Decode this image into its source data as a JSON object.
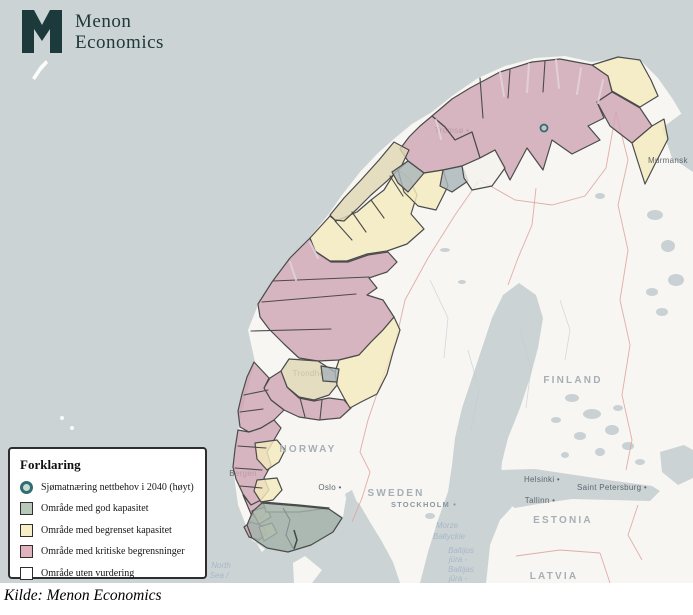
{
  "logo": {
    "line1": "Menon",
    "line2": "Economics",
    "mark_color": "#1c393b"
  },
  "caption": {
    "text": "Kilde: Menon Economics"
  },
  "legend": {
    "title": "Forklaring",
    "items": [
      {
        "shape": "circle",
        "ring": "#2c6e73",
        "fill": "#cdd9d0",
        "label": "Sjømatnæring nettbehov i 2040 (høyt)"
      },
      {
        "shape": "square",
        "fill": "#b7c8b8",
        "label": "Område med god kapasitet"
      },
      {
        "shape": "square",
        "fill": "#f7eec7",
        "label": "Område med begrenset kapasitet"
      },
      {
        "shape": "square",
        "fill": "#e0b3bf",
        "label": "Område med kritiske begrensninger"
      },
      {
        "shape": "square",
        "fill": "#ffffff",
        "label": "Område uten vurdering"
      }
    ]
  },
  "map": {
    "colors": {
      "sea": "#cbd3d4",
      "land": "#f7f6f2",
      "lake": "#c9d1d4",
      "pink": "#cfa6b5",
      "cream": "#f4eabd",
      "tan": "#e0d7b3",
      "green": "#a3b3ab",
      "grayreg": "#a9b6bb",
      "whitereg": "#f3f1ec",
      "stroke": "#4b4b4b",
      "border": "#e0a49f",
      "countryLabel": "#a6aeb6",
      "cityLabel": "#5e6770",
      "seaLabel": "#a8b8c8",
      "accent": "#2c6e73"
    },
    "shapes": {
      "mainland": "262,552 247,528 238,505 233,468 238,430 246,395 255,362 248,330 258,305 272,282 290,258 310,237 328,215 342,195 360,172 378,153 395,138 412,124 432,112 452,96 478,78 505,66 535,58 565,56 592,62 618,58 642,62 658,78 672,98 684,118 693,133 693,583 400,583 393,562 381,540 370,522 360,505 352,496 346,499 343,517 330,509 299,506 262,503 252,510 247,524 252,540 265,549",
      "denmark": "293,563 305,556 322,570 312,583 294,583",
      "janmayen": "32,78 40,66 46,60 48,63 41,71 35,80",
      "bothnia": "519,283 536,295 543,318 538,348 530,378 520,408 508,438 502,462 500,488 512,507 500,520 490,545 488,565 486,583 420,583 428,552 438,520 448,492 452,465 455,438 462,408 472,378 482,348 492,318 503,295",
      "gulfFinland": "500,470 535,469 575,475 615,481 652,486 660,491 650,501 612,500 572,499 538,504 515,508 502,500 498,484",
      "ladoga": "660,452 684,445 693,450 693,478 678,485 662,472",
      "oslofjord": "345,494 352,490 360,510 368,530 375,548 380,562 371,556 360,535 350,512",
      "varanger": "693,105 662,128 672,158 693,172"
    },
    "islands": [
      [
        62,
        418,
        2
      ],
      [
        72,
        428,
        2
      ],
      [
        470,
        470,
        1.5
      ],
      [
        463,
        476,
        1.5
      ]
    ],
    "archipelago": [
      [
        448,
        508
      ],
      [
        455,
        512
      ],
      [
        461,
        505
      ],
      [
        452,
        517
      ]
    ],
    "lakes": [
      [
        572,
        398,
        7,
        4
      ],
      [
        592,
        414,
        9,
        5
      ],
      [
        612,
        430,
        7,
        5
      ],
      [
        628,
        446,
        6,
        4
      ],
      [
        580,
        436,
        6,
        4
      ],
      [
        556,
        420,
        5,
        3
      ],
      [
        600,
        452,
        5,
        4
      ],
      [
        640,
        462,
        5,
        3
      ],
      [
        655,
        215,
        8,
        5
      ],
      [
        668,
        246,
        7,
        6
      ],
      [
        676,
        280,
        8,
        6
      ],
      [
        652,
        292,
        6,
        4
      ],
      [
        662,
        312,
        6,
        4
      ],
      [
        600,
        196,
        5,
        3
      ],
      [
        470,
        448,
        6,
        3
      ],
      [
        486,
        442,
        5,
        3
      ],
      [
        430,
        516,
        5,
        3
      ],
      [
        444,
        532,
        5,
        3
      ],
      [
        456,
        548,
        4,
        3
      ],
      [
        445,
        250,
        5,
        2
      ],
      [
        462,
        282,
        4,
        2
      ],
      [
        500,
        330,
        4,
        2
      ],
      [
        618,
        408,
        5,
        3
      ],
      [
        565,
        455,
        4,
        3
      ]
    ],
    "rivers": [
      "430,280 448,318 444,358",
      "468,350 479,390 471,430",
      "520,330 531,368 526,408",
      "560,300 570,330 565,360"
    ],
    "borders": [
      "478,182 455,215 428,258 405,300 396,340 380,385 368,420 360,452 370,472 362,498 352,522",
      "616,112 628,160 618,205 628,250 620,300 630,345 622,395 632,440 626,470",
      "536,188 532,225 518,258 508,285",
      "480,180 515,200 552,205 585,196 606,168 616,112",
      "516,556 560,550 600,553",
      "600,553 610,583",
      "638,505 628,535 642,560"
    ],
    "regions": [
      {
        "name": "kritiske-finnmark",
        "cat": "pink",
        "pts": "432,116 452,99 470,88 500,72 532,62 560,59 592,65 608,76 612,92 597,102 604,118 588,126 600,140 572,154 552,140 543,170 527,148 510,180 495,150 480,158 472,132 455,140 445,127"
      },
      {
        "name": "kritiske-varanger",
        "cat": "pink",
        "pts": "597,102 612,92 640,108 652,126 632,143 610,126"
      },
      {
        "name": "kritiske-troms",
        "cat": "pink",
        "pts": "432,116 445,127 455,140 472,132 480,158 462,166 443,170 424,173 408,161 400,149 409,137 420,126"
      },
      {
        "name": "kritiske-helgeland",
        "cat": "pink",
        "pts": "258,304 272,282 290,258 310,238 316,252 331,262 348,262 368,255 388,252 397,262 387,272 369,278 377,288 367,295 383,300 394,317 383,330 371,342 359,355 339,360 318,361 299,358 284,344 269,329 260,317"
      },
      {
        "name": "kritiske-fosen",
        "cat": "pink",
        "pts": "281,371 288,388 299,398 314,401 329,398 344,400 351,408 340,418 319,420 299,417 284,410 271,400 264,388 270,378"
      },
      {
        "name": "kritiske-more",
        "cat": "pink",
        "pts": "254,362 269,378 264,388 271,400 284,410 274,420 261,428 249,432 240,427 238,411 242,394 247,377"
      },
      {
        "name": "kritiske-vestland",
        "cat": "pink",
        "pts": "238,430 249,432 261,428 274,420 281,428 274,440 267,452 271,465 264,478 269,490 261,500 251,505 243,494 236,479 233,467 235,449"
      },
      {
        "name": "kritiske-sor-a",
        "cat": "pink",
        "pts": "243,495 251,505 261,500 267,510 261,519 251,514"
      },
      {
        "name": "kritiske-sor-b",
        "cat": "pink",
        "pts": "251,522 263,526 267,533 259,540 249,537 244,527"
      },
      {
        "name": "begrenset-ost-finnmark",
        "cat": "cream",
        "pts": "592,65 618,57 640,60 651,80 658,96 640,107 612,91 608,76"
      },
      {
        "name": "begrenset-varanger-kyst",
        "cat": "cream",
        "pts": "632,143 652,126 664,119 668,139 655,164 645,184 637,159"
      },
      {
        "name": "begrenset-vesteralen",
        "cat": "cream",
        "pts": "310,238 330,216 336,221 357,212 371,200 384,190 397,169 409,178 417,195 411,214 424,229 407,244 387,251 367,254 347,261 330,261 315,251"
      },
      {
        "name": "begrenset-troms-indre",
        "cat": "cream",
        "pts": "398,170 408,161 424,173 443,170 448,186 436,210 418,206 404,192"
      },
      {
        "name": "begrenset-trondelag",
        "cat": "cream",
        "pts": "339,360 359,355 371,342 383,330 394,317 400,330 393,352 387,374 377,394 361,402 350,408 344,398 337,385 335,372"
      },
      {
        "name": "begrenset-nordhordland",
        "cat": "cream",
        "pts": "255,443 277,440 285,450 279,462 267,470 257,459"
      },
      {
        "name": "begrenset-sunnhordland",
        "cat": "cream",
        "pts": "257,480 277,478 282,490 273,500 261,502 254,491"
      },
      {
        "name": "begrenset-rogaland-a",
        "cat": "cream",
        "pts": "252,511 266,507 271,517 259,524"
      },
      {
        "name": "begrenset-rogaland-b",
        "cat": "cream",
        "pts": "259,527 272,523 277,533 264,541"
      },
      {
        "name": "begrenset-senja",
        "cat": "tan",
        "pts": "330,215 344,198 361,180 379,160 394,142 409,150 401,167 387,181 371,195 357,209 344,221 335,220"
      },
      {
        "name": "begrenset-trondheim",
        "cat": "tan",
        "pts": "289,359 318,361 335,372 337,385 329,395 314,400 299,397 287,387 281,371"
      },
      {
        "name": "fjord-troms-a",
        "cat": "grayreg",
        "pts": "408,161 424,173 408,192 398,183 392,172"
      },
      {
        "name": "fjord-troms-b",
        "cat": "grayreg",
        "pts": "443,170 462,166 468,181 452,192 440,186"
      },
      {
        "name": "fjord-trondheim",
        "cat": "grayreg",
        "pts": "321,366 339,369 337,382 323,381"
      },
      {
        "name": "uten-vurdering-indre-troms",
        "cat": "whitereg",
        "pts": "462,166 480,158 495,150 505,168 492,186 472,190 464,178"
      },
      {
        "name": "uten-vurdering-sor",
        "cat": "whitereg",
        "pts": "263,502 299,505 329,508 299,512 266,512"
      },
      {
        "name": "god-kapasitet-agder",
        "cat": "green",
        "pts": "262,503 299,506 329,509 342,518 333,532 311,545 288,552 267,548 252,538 247,525 253,511"
      }
    ],
    "dividers": [
      "480,78 483,118",
      "510,70 508,98",
      "545,61 543,92",
      "273,281 369,277",
      "262,302 356,294",
      "251,331 331,329",
      "244,395 268,390",
      "240,412 263,409",
      "238,446 266,448",
      "235,468 262,470",
      "240,486 262,488",
      "335,221 352,240",
      "352,212 366,232",
      "371,200 384,218",
      "390,176 403,196",
      "300,398 305,417",
      "322,400 320,419"
    ],
    "fjordStrokes": [
      "500,72 504,96",
      "529,64 527,92",
      "556,60 559,88",
      "581,68 577,94",
      "603,80 598,103",
      "436,120 441,139",
      "290,262 296,280",
      "310,242 318,258"
    ],
    "greenDetail": "283,508 290,520 286,535 293,548",
    "darkMark": "294,530 297,540 294,549",
    "markers": [
      {
        "x": 544,
        "y": 128
      }
    ],
    "labels": {
      "countries": [
        {
          "text": "NORWAY",
          "x": 308,
          "y": 452
        },
        {
          "text": "SWEDEN",
          "x": 396,
          "y": 496
        },
        {
          "text": "FINLAND",
          "x": 573,
          "y": 383
        },
        {
          "text": "ESTONIA",
          "x": 563,
          "y": 523
        },
        {
          "text": "LATVIA",
          "x": 554,
          "y": 579
        }
      ],
      "smallCaps": [
        {
          "text": "STOCKHOLM",
          "x": 424,
          "y": 507,
          "dot": true
        }
      ],
      "cities": [
        {
          "text": "Oslo",
          "x": 330,
          "y": 490,
          "dot": true
        },
        {
          "text": "Helsinki",
          "x": 542,
          "y": 482,
          "dot": true
        },
        {
          "text": "Tallinn",
          "x": 540,
          "y": 503,
          "dot": true
        },
        {
          "text": "Saint Petersburg",
          "x": 612,
          "y": 490,
          "dot": true
        },
        {
          "text": "Murmansk",
          "x": 648,
          "y": 163,
          "anchor": "start"
        }
      ],
      "dimCities": [
        {
          "text": "Tromsø",
          "x": 452,
          "y": 133,
          "dot": true
        },
        {
          "text": "Trondheim",
          "x": 313,
          "y": 376
        },
        {
          "text": "Bergen",
          "x": 243,
          "y": 476
        }
      ],
      "seas": [
        {
          "text": "Morze",
          "x": 447,
          "y": 528
        },
        {
          "text": "Bałtyckie",
          "x": 449,
          "y": 539
        },
        {
          "text": "Baltijos",
          "x": 461,
          "y": 553
        },
        {
          "text": "jūra -",
          "x": 458,
          "y": 562
        },
        {
          "text": "Baltijas",
          "x": 461,
          "y": 572
        },
        {
          "text": "jūra -",
          "x": 458,
          "y": 581
        },
        {
          "text": "North",
          "x": 221,
          "y": 568
        },
        {
          "text": "Sea /",
          "x": 219,
          "y": 578
        }
      ]
    }
  }
}
